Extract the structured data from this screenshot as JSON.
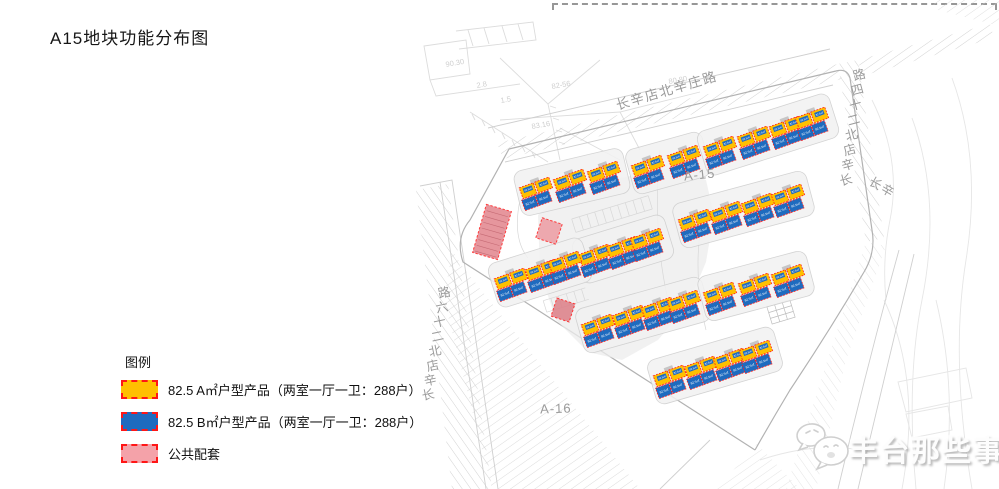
{
  "title": "A15地块功能分布图",
  "legend": {
    "heading": "图例",
    "items": [
      {
        "name": "type-a-product",
        "color": "#FFC000",
        "label": "82.5 A㎡户型产品（两室一厅一卫：288户）"
      },
      {
        "name": "type-b-product",
        "color": "#1E6BBF",
        "label": "82.5 B㎡户型产品（两室一厅一卫：288户）"
      },
      {
        "name": "public-amenity",
        "color": "#F4A2A9",
        "label": "公共配套"
      }
    ]
  },
  "map": {
    "plot_labels": [
      {
        "text": "A-15",
        "x": 700,
        "y": 179,
        "rotate": -6
      },
      {
        "text": "A-16",
        "x": 556,
        "y": 413,
        "rotate": -2
      }
    ],
    "road_labels_horizontal": [
      {
        "text": "长辛店北辛庄路",
        "x": 668,
        "y": 95,
        "rotate": -16.5,
        "size": 13.5
      },
      {
        "text": "长辛",
        "x": 880,
        "y": 191,
        "rotate": 30,
        "size": 12.5
      }
    ],
    "road_labels_along_line": [
      {
        "text": "长辛店北二十四路",
        "x": 847,
        "y": 184,
        "dx": 1.9,
        "dy": -15.0,
        "char_rotate": -15,
        "size": 12.5
      },
      {
        "text": "长辛店北二十六路",
        "x": 429,
        "y": 399,
        "dx": 2.3,
        "dy": -14.6,
        "char_rotate": -12,
        "size": 12.5
      }
    ],
    "survey_numbers": [
      {
        "text": "90.30",
        "x": 446,
        "y": 67
      },
      {
        "text": "2.8",
        "x": 477,
        "y": 88
      },
      {
        "text": "82-56",
        "x": 552,
        "y": 89
      },
      {
        "text": "1.5",
        "x": 501,
        "y": 103
      },
      {
        "text": "83.16",
        "x": 532,
        "y": 129
      },
      {
        "text": "80.80",
        "x": 669,
        "y": 84
      }
    ],
    "buildings": {
      "unit_label": "82.5㎡",
      "unit_rotation": -20,
      "type_a_color": "#FFC000",
      "type_b_color": "#1E6BBF",
      "outline_color": "#FF1A1A",
      "rows": [
        {
          "units": [
            [
              538,
              190
            ],
            [
              572,
              182
            ],
            [
              606,
              174
            ]
          ]
        },
        {
          "units": [
            [
              650,
              168
            ],
            [
              686,
              158
            ]
          ]
        },
        {
          "units": [
            [
              722,
              149
            ],
            [
              756,
              139
            ],
            [
              788,
              129
            ],
            [
              814,
              120
            ]
          ]
        },
        {
          "units": [
            [
              697,
              222
            ],
            [
              728,
              214
            ],
            [
              760,
              206
            ],
            [
              790,
              197
            ]
          ]
        },
        {
          "units": [
            [
              597,
              257
            ],
            [
              625,
              249
            ],
            [
              649,
              241
            ]
          ]
        },
        {
          "units": [
            [
              513,
              281
            ],
            [
              544,
              272
            ],
            [
              567,
              264
            ]
          ]
        },
        {
          "units": [
            [
              600,
              327
            ],
            [
              631,
              318
            ],
            [
              660,
              310
            ],
            [
              686,
              303
            ]
          ]
        },
        {
          "units": [
            [
              722,
              295
            ],
            [
              757,
              286
            ],
            [
              790,
              277
            ]
          ]
        },
        {
          "units": [
            [
              672,
              378
            ],
            [
              703,
              369
            ],
            [
              732,
              361
            ],
            [
              758,
              353
            ]
          ]
        }
      ]
    },
    "amenities": [
      {
        "x": 492,
        "y": 232,
        "w": 26,
        "h": 50,
        "rotate": 16,
        "fill": "#E2848D",
        "striped": true
      },
      {
        "x": 549,
        "y": 231,
        "w": 21,
        "h": 21,
        "rotate": 18,
        "fill": "#ED9CA3",
        "striped": false
      },
      {
        "x": 563,
        "y": 310,
        "w": 19,
        "h": 19,
        "rotate": 18,
        "fill": "#DD7E87",
        "striped": false
      }
    ]
  },
  "watermark": {
    "text": "丰台那些事"
  }
}
